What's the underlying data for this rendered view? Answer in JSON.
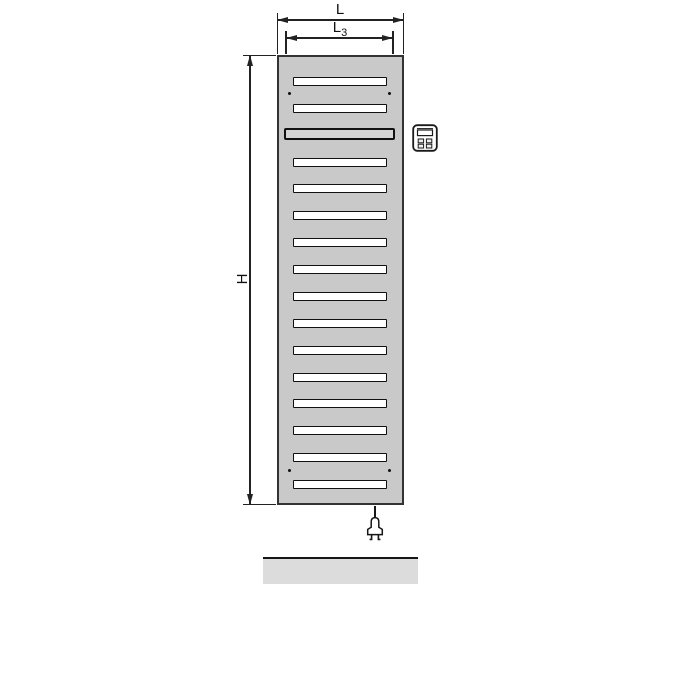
{
  "diagram": {
    "type": "radiator-dimension-drawing",
    "background": "#ffffff",
    "line_color": "#222222"
  },
  "dimensions": {
    "width": {
      "label": "L"
    },
    "inner_width": {
      "label": "L",
      "subscript": "3"
    },
    "height": {
      "label": "H"
    }
  },
  "radiator": {
    "body_color": "#c9c9c9",
    "outline_color": "#333333",
    "slot_count": 16,
    "slot_color": "#ffffff",
    "wide_slot_index": 3,
    "wide_slot_color": "#d6d6d6",
    "screw_hole_count": 4,
    "screw_hole_color": "#111111"
  },
  "accessories": {
    "control_unit_icon": "control-unit-icon",
    "power_cable": "power-cable",
    "power_plug_icon": "power-plug-icon"
  },
  "floor": {
    "color": "#dcdcdc"
  }
}
